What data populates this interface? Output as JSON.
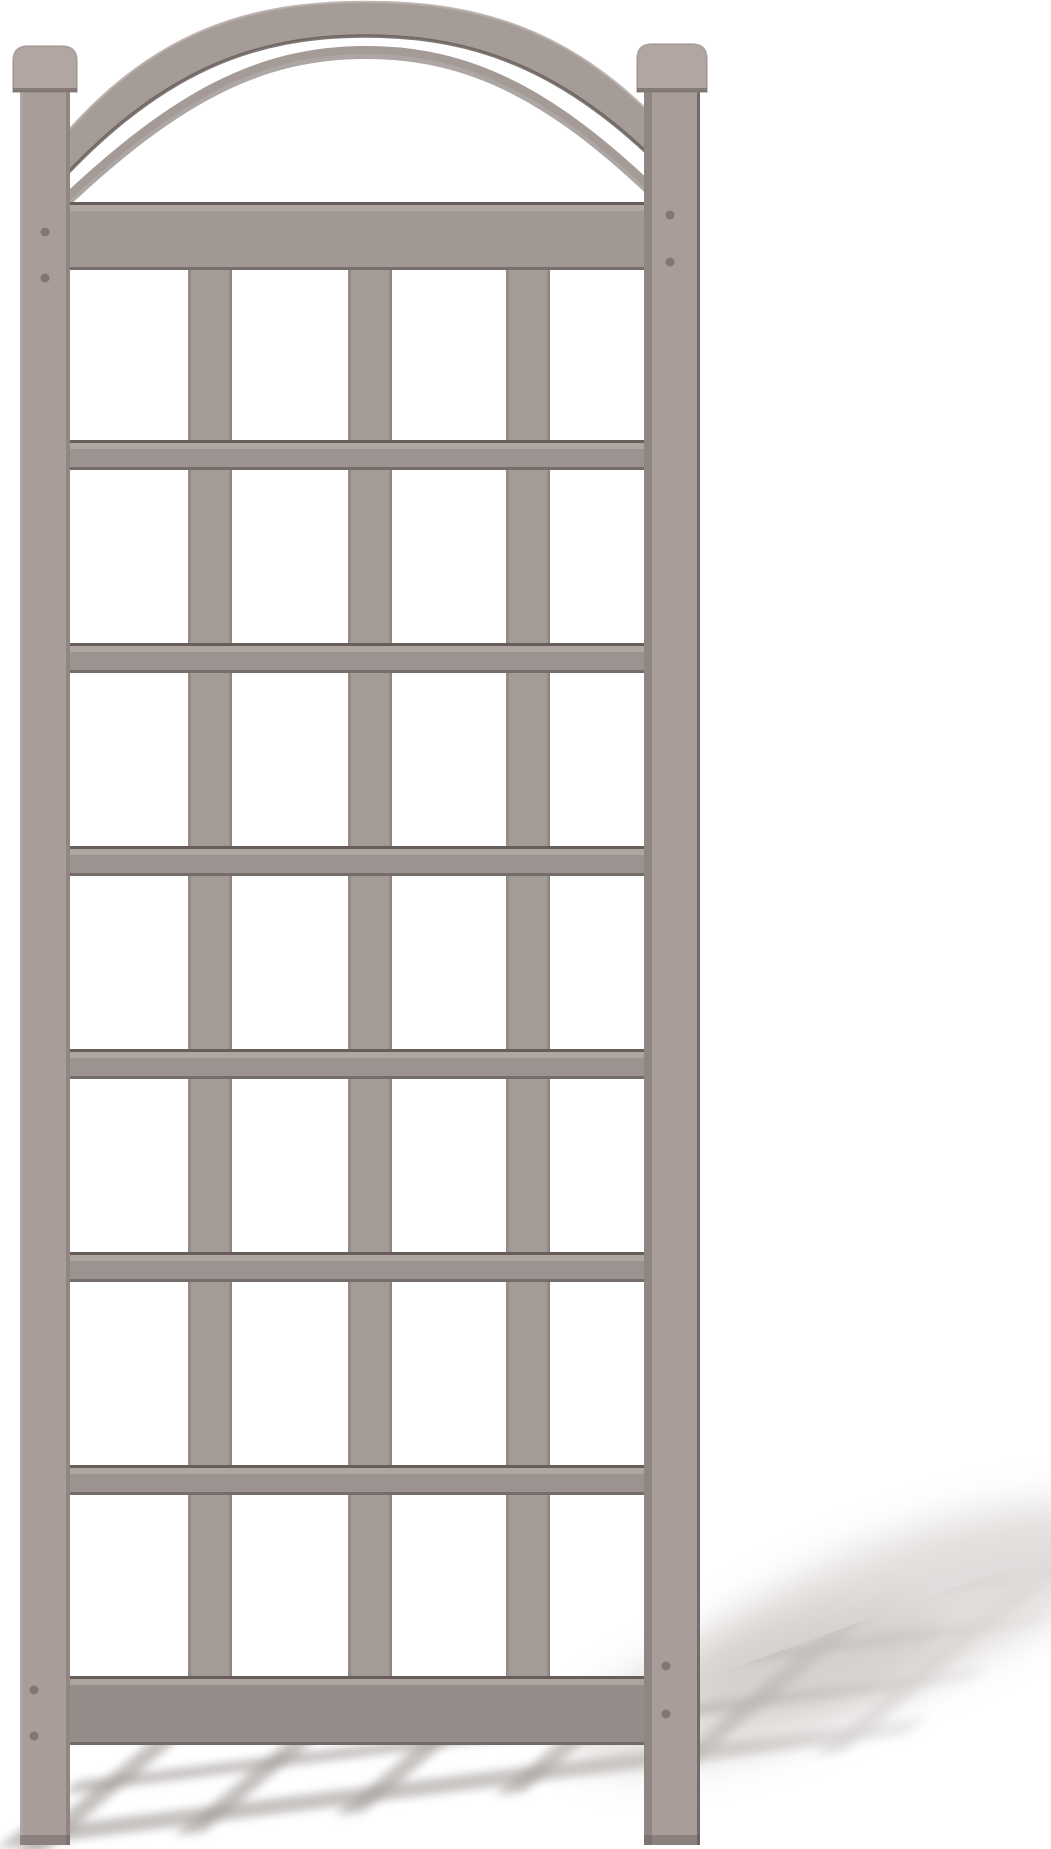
{
  "meta": {
    "description": "Product photograph of a taupe-gray vinyl garden trellis with an arched top and square lattice grid, standing upright on a white background. A blurred lattice-pattern shadow is cast on the ground toward the lower right.",
    "canvas": {
      "width": 1051,
      "height": 1849
    },
    "background": "#ffffff"
  },
  "palette": {
    "post_face": "#a89d99",
    "post_face_light": "#b0a5a0",
    "rail_face": "#9c9290",
    "header_face": "#a19793",
    "footer_face": "#958b88",
    "slat_face": "#a49a96",
    "arch_face": "#a59b97",
    "cap_face": "#b1a6a1",
    "edge_dark": "#675e5a",
    "edge_darker": "#554e4a",
    "top_light": "#b6aca7",
    "side_shade": "#8f8681",
    "screw": "#7b706c",
    "shadow_band": "#a09997",
    "shadow_soft": "#c9c3c0"
  },
  "trellis": {
    "posts": {
      "left": {
        "x": 20,
        "width": 50,
        "top": 88,
        "bottom": 1845
      },
      "right": {
        "x": 644,
        "width": 56,
        "top": 88,
        "bottom": 1845
      }
    },
    "caps": {
      "left": {
        "x": 13,
        "width": 64,
        "top": 46,
        "height": 46,
        "radius": 15
      },
      "right": {
        "x": 637,
        "width": 70,
        "top": 44,
        "height": 48,
        "radius": 15
      }
    },
    "arch": {
      "band_path": "M52,150 C150,30 250,2 366,2 C482,2 582,30 684,150 L684,190 C572,70 477,36 366,36 C255,36 160,70 52,190 Z",
      "top_edge_path": "M52,150 C150,30 250,2 366,2 C482,2 582,30 684,150",
      "bottom_edge_path": "M52,190 C160,70 255,36 366,36 C477,36 572,70 684,190",
      "under_curve_shadow_path": "M62,206 C176,98 260,54 366,54 C472,54 556,98 666,206",
      "under_curve_path": "M62,202 C176,94 260,50 366,50 C472,50 556,94 666,202"
    },
    "header_rail": {
      "x1": 70,
      "x2": 644,
      "y": 202,
      "height": 68
    },
    "footer_rail": {
      "x1": 70,
      "x2": 644,
      "y": 1676,
      "height": 69
    },
    "thin_rails_y": [
      440,
      643,
      846,
      1049,
      1252,
      1465
    ],
    "thin_rail_height": 30,
    "rail_x1": 70,
    "rail_x2": 644,
    "slats": {
      "xs": [
        188,
        348,
        506
      ],
      "width": 44,
      "top": 270,
      "bottom": 1676
    },
    "screws": {
      "left": [
        [
          45,
          232
        ],
        [
          45,
          278
        ],
        [
          34,
          1690
        ],
        [
          34,
          1736
        ]
      ],
      "right": [
        [
          670,
          215
        ],
        [
          670,
          262
        ],
        [
          666,
          1666
        ],
        [
          666,
          1714
        ]
      ]
    }
  },
  "ground_shadow": {
    "matrix": [
      1,
      -0.125,
      0.62,
      -0.52,
      64,
      1814
    ],
    "rail_bands_v": [
      {
        "v": -60,
        "h": 36
      },
      {
        "v": 45,
        "h": 26
      },
      {
        "v": 150,
        "h": 26
      },
      {
        "v": 255,
        "h": 26
      }
    ],
    "slat_bands_u": [
      0,
      160,
      320,
      480,
      640,
      800
    ],
    "slat_band_width": 30,
    "u_extent": [
      -30,
      880
    ],
    "v_extent": [
      -80,
      400
    ],
    "band_opacity": 0.62,
    "clip_path": "M0,1758 L660,1695 L1051,1552 L1051,1849 L0,1849 Z",
    "blur": 4.5,
    "soft_blobs": [
      {
        "cx": 900,
        "cy": 1612,
        "rx": 235,
        "ry": 72,
        "rotate": -21,
        "opacity": 0.55
      },
      {
        "cx": 755,
        "cy": 1688,
        "rx": 195,
        "ry": 62,
        "rotate": -17,
        "opacity": 0.45
      }
    ],
    "fade": {
      "x1": 210,
      "y1": 1849,
      "x2": 1020,
      "y2": 1540
    }
  }
}
